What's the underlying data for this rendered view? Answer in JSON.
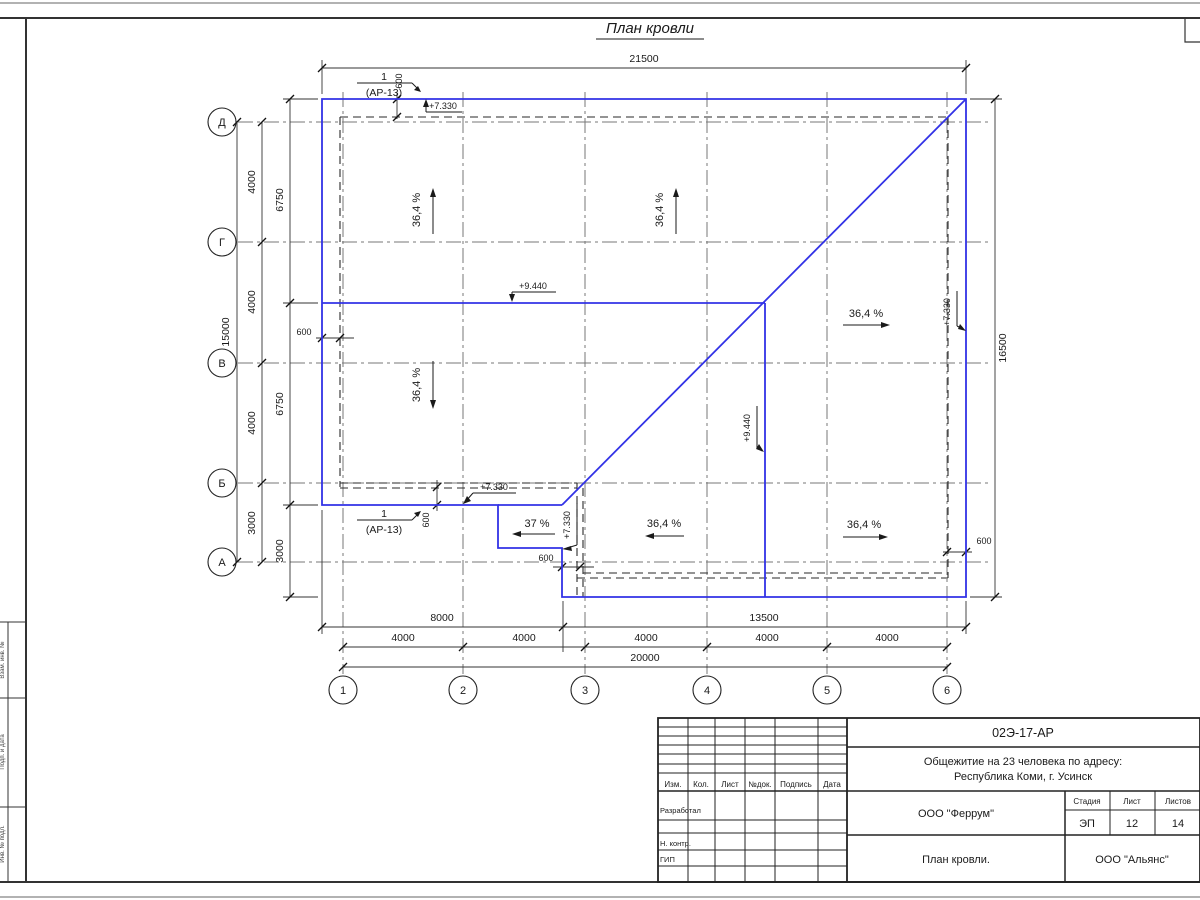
{
  "title": "План кровли",
  "axes": {
    "rows": [
      "Д",
      "Г",
      "В",
      "Б",
      "А"
    ],
    "cols": [
      "1",
      "2",
      "3",
      "4",
      "5",
      "6"
    ]
  },
  "dims": {
    "d21500": "21500",
    "d16500": "16500",
    "d15000": "15000",
    "d6750": "6750",
    "d4000": "4000",
    "d3000": "3000",
    "d600": "600",
    "d8000": "8000",
    "d13500": "13500",
    "d20000": "20000"
  },
  "marks": {
    "e7330": "+7.330",
    "e9440": "+9.440",
    "slope364": "36,4 %",
    "slope37": "37 %",
    "callout_num": "1",
    "callout_ref": "(АР-13)"
  },
  "titleblock": {
    "code": "02Э-17-АР",
    "project1": "Общежитие на 23 человека по адресу:",
    "project2": "Республика Коми, г. Усинск",
    "org": "ООО \"Феррум\"",
    "stage_label": "Стадия",
    "sheet_label": "Лист",
    "sheets_label": "Листов",
    "stage": "ЭП",
    "sheet": "12",
    "sheets": "14",
    "name": "План кровли.",
    "org2": "ООО \"Альянс\"",
    "h_izm": "Изм.",
    "h_kol": "Кол.",
    "h_list": "Лист",
    "h_ndok": "№док.",
    "h_podp": "Подпись",
    "h_data": "Дата",
    "r_razrab": "Разработал",
    "r_nkontr": "Н. контр.",
    "r_gip": "ГИП"
  },
  "sidestrip": {
    "c1": "Взам. инв. №",
    "c2": "Подп. и дата",
    "c3": "Инв. № подл."
  }
}
